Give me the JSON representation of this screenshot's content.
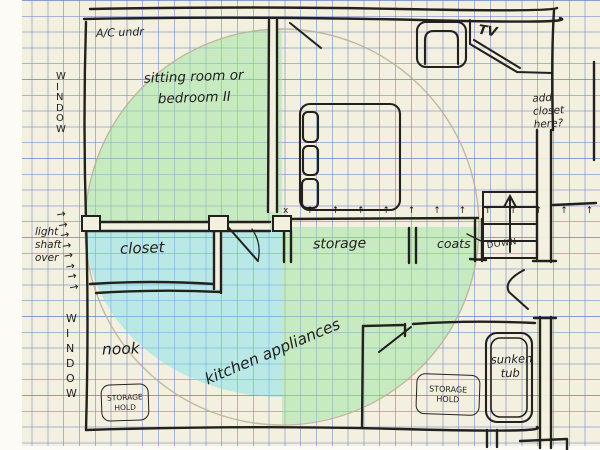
{
  "meta": {
    "title": "Hand-drawn apartment floor plan sketch on graph paper"
  },
  "colors": {
    "paper": "#f4f0df",
    "grid_blue": "#587ac6",
    "ink": "#22211d",
    "pencil_circle": "#b7af97",
    "green_fill": "#9be3a4",
    "cyan_fill": "#73ddf1"
  },
  "labels": {
    "ac": "A/C undr",
    "window_top": "W\nI\nN\nD\nO\nW",
    "window_bottom": "W\nI\nN\nD\nO\nW",
    "sitting_room": "sitting room or\nbedroom II",
    "tv": "TV",
    "add_closet_note": "add\ncloset\nhere?",
    "light_shaft_note": "light\nshaft\nover",
    "light_shaft_arrows": "→\n→\n→\n→\n→\n→\n→\n→",
    "closet": "closet",
    "storage": "storage",
    "coats": "coats",
    "stairs_down": "DOWN",
    "hook_row": "x ↑ ↑ ↑ ↑ ↑ ↑ ↑ ↑ ↑ ↑ ↑ ↑ ↑",
    "nook": "nook",
    "kitchen": "kitchen appliances",
    "storage_hold_left": "STORAGE\nHOLD",
    "storage_hold_right": "STORAGE\nHOLD",
    "sunken_tub": "sunken\ntub"
  }
}
